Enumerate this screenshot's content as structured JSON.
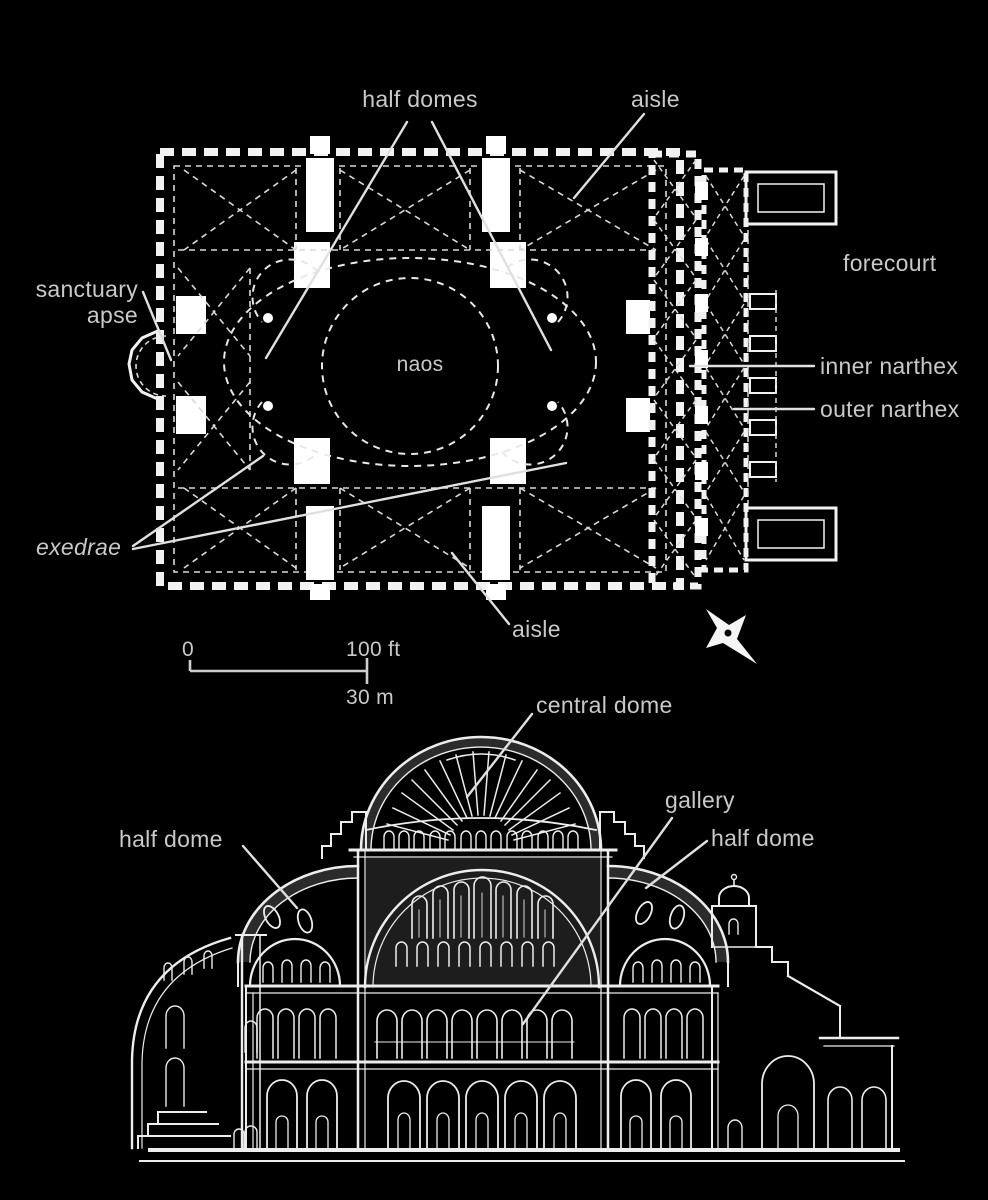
{
  "colors": {
    "background": "#000000",
    "line": "#f2f2f2",
    "label": "#c9c9c9",
    "leader": "#e0e0e0"
  },
  "plan": {
    "labels": {
      "half_domes": "half domes",
      "aisle_top": "aisle",
      "forecourt": "forecourt",
      "sanctuary_line1": "sanctuary",
      "sanctuary_line2": "apse",
      "naos": "naos",
      "inner_narthex": "inner narthex",
      "outer_narthex": "outer narthex",
      "exedrae": "exedrae",
      "aisle_bottom": "aisle"
    },
    "scale_bar": {
      "zero": "0",
      "feet": "100 ft",
      "meters": "30 m"
    },
    "icons": {
      "compass": "compass-rose"
    }
  },
  "section": {
    "labels": {
      "central_dome": "central dome",
      "gallery": "gallery",
      "half_dome_left": "half dome",
      "half_dome_right": "half dome"
    }
  }
}
